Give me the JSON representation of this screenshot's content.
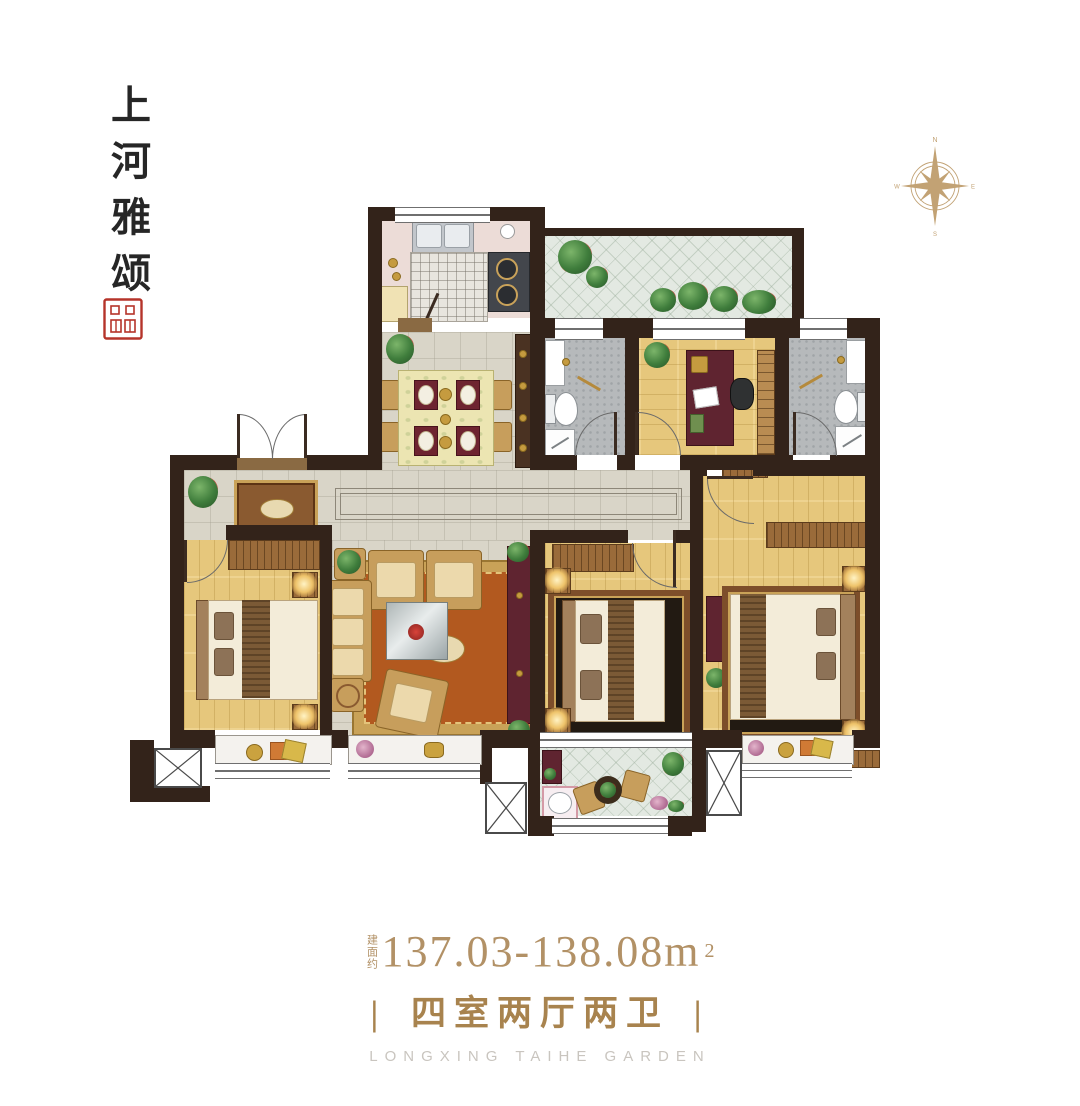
{
  "brand": {
    "name": "上河雅颂"
  },
  "compass": {
    "north": "N",
    "east": "E",
    "south": "S",
    "west": "W"
  },
  "footer": {
    "area_prefix": "建面约",
    "area_value": "137.03-138.08m",
    "area_sup": "2",
    "tagline_bar_left": "|",
    "tagline": "四室两厅两卫",
    "tagline_bar_right": "|",
    "garden_name": "LONGXING TAIHE GARDEN"
  },
  "colors": {
    "wall": "#33231a",
    "area_text_gold": "#b29166",
    "tagline_gold": "#a8834e",
    "garden_gray": "#c9c5bf",
    "seal_red": "#b5342a",
    "compass_gold": "#c2a274",
    "wood_floor": "#e6c77c",
    "marble_floor": "#d9d5c8"
  }
}
